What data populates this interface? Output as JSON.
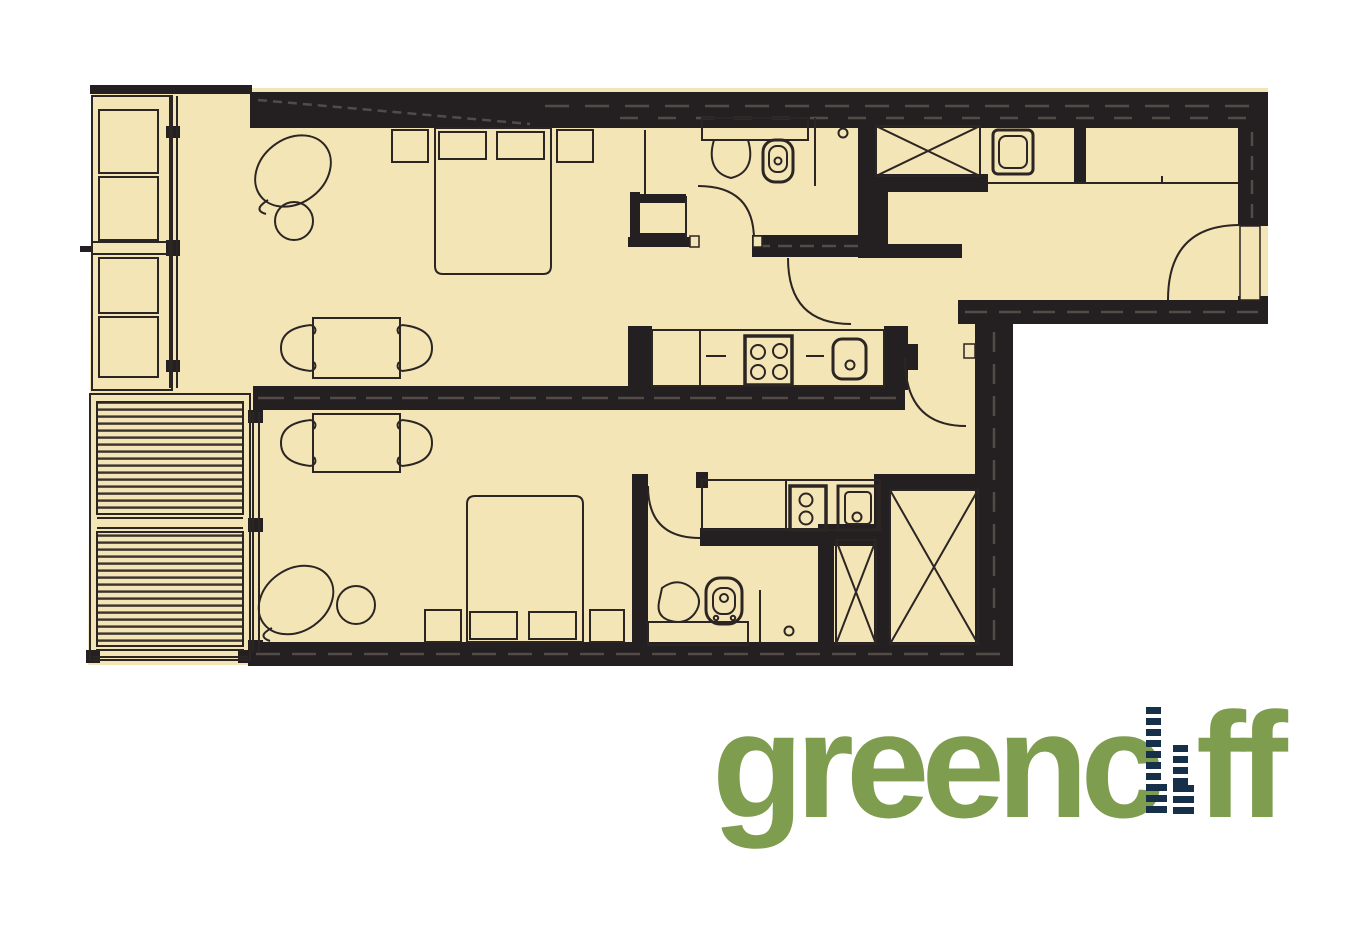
{
  "page": {
    "background": "#ffffff"
  },
  "floorplan": {
    "type": "architectural-floor-plan",
    "floor_color": "#f4e5b6",
    "wall_color": "#242021",
    "line_color": "#2b2523",
    "hatch_color": "#5a544f",
    "deck_stripe_color": "#3a332f",
    "upper_unit": {
      "living_bedroom_icons": [
        "double-bed",
        "pillows",
        "bedside-table",
        "bedside-table",
        "armchair",
        "round-side-table",
        "dining-table",
        "dining-chair",
        "dining-chair"
      ],
      "kitchen_icons": [
        "four-burner-cooktop",
        "kitchen-sink"
      ],
      "bathroom_icons": [
        "vanity-basin",
        "toilet",
        "shower-screen",
        "floor-drain"
      ],
      "balcony_icons": [
        "planter-box",
        "planter-box",
        "planter-box",
        "planter-box"
      ]
    },
    "lower_unit": {
      "living_bedroom_icons": [
        "double-bed",
        "pillows",
        "bedside-table",
        "bedside-table",
        "armchair",
        "round-side-table",
        "dining-table",
        "dining-chair",
        "dining-chair"
      ],
      "kitchen_icons": [
        "two-burner-cooktop",
        "kitchen-sink"
      ],
      "bathroom_icons": [
        "pedestal-basin",
        "toilet",
        "shower-screen",
        "floor-drain",
        "bench"
      ],
      "deck_icons": [
        "timber-deck-boards"
      ],
      "wardrobe_icons": [
        "wardrobe-x-box",
        "wardrobe-x-box"
      ]
    },
    "shared_entry": {
      "icons": [
        "entry-door-swing",
        "laundry-tub",
        "bench-counter",
        "wardrobe-x-box",
        "door-swing",
        "door-swing",
        "door-swing",
        "door-swing"
      ]
    }
  },
  "logo": {
    "brand": "greencliff",
    "text_before_bars": "greenc",
    "text_after_bars": "ff",
    "green": "#7f9d4f",
    "navy": "#16304a"
  }
}
